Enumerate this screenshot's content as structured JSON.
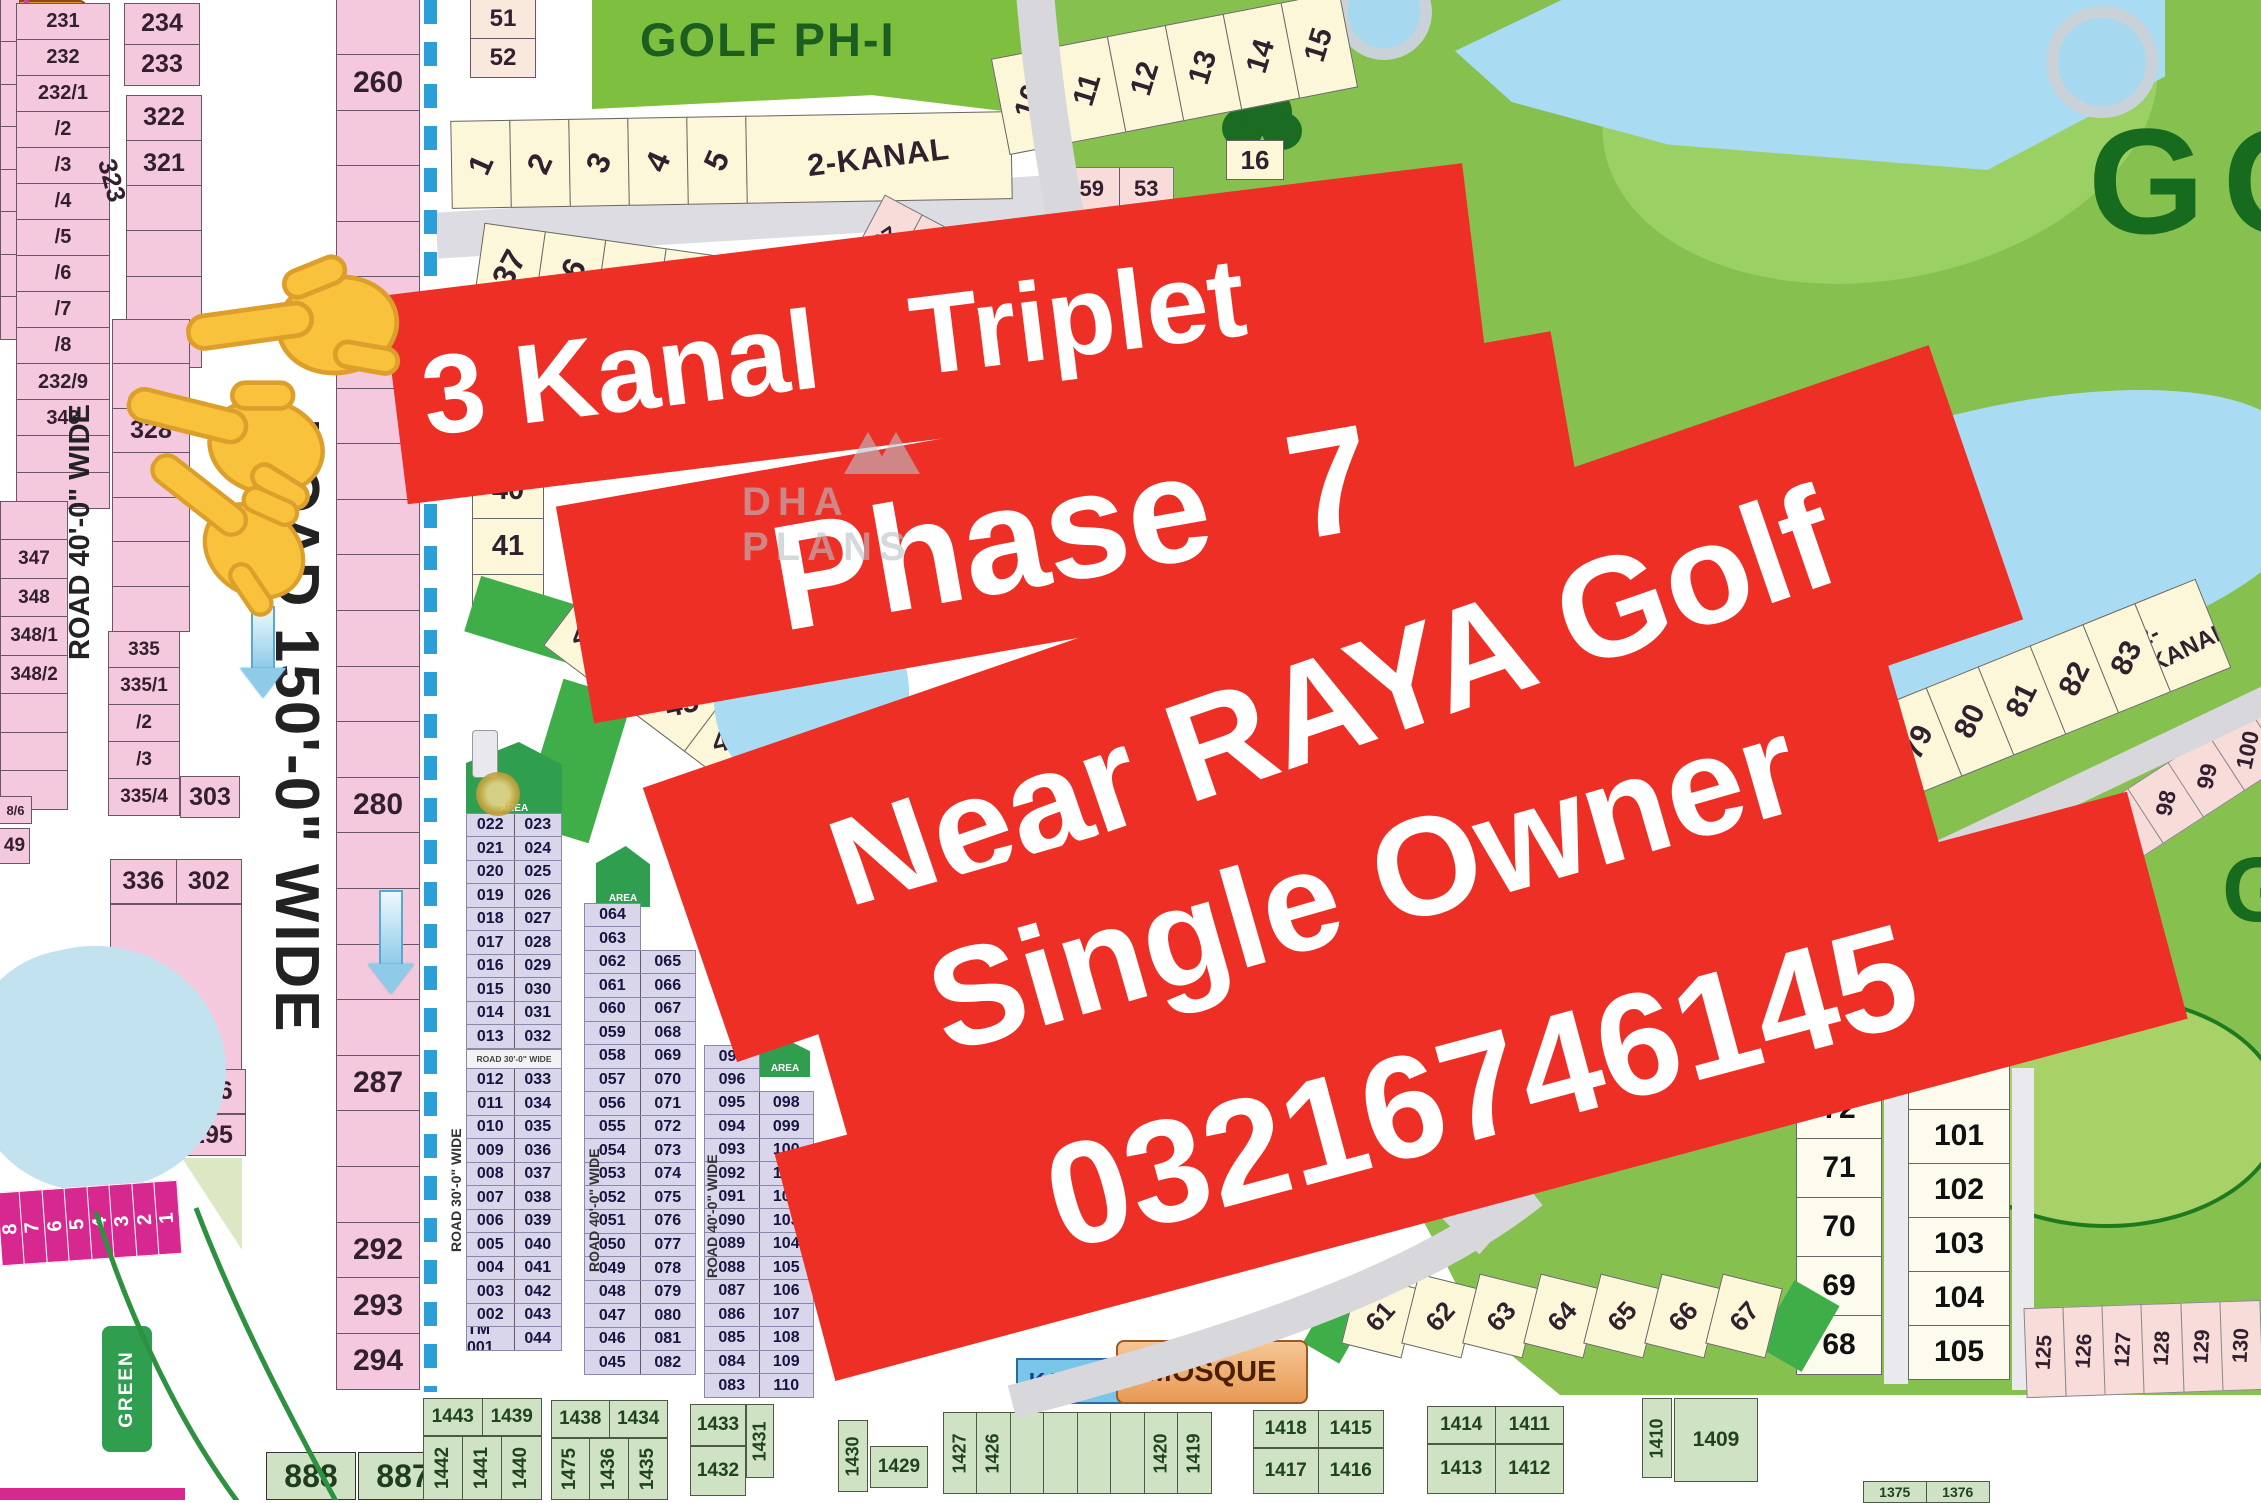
{
  "colors": {
    "banner_red": "#ee2f26",
    "pink": "#f5c9dd",
    "pink_light": "#f8dcda",
    "yellow": "#fbf7d8",
    "lavender": "#d9d5eb",
    "green_bright": "#3fae49",
    "green_cell": "#cfe3c4",
    "water": "#a9dcf2",
    "magenta": "#d6288e",
    "orange": "#e89440",
    "cyan": "#7ac6e8",
    "dashed_blue": "#2ba0d8"
  },
  "banner": {
    "lines": [
      "3 Kanal   Triplet",
      "Phase 7",
      "Near RAYA Golf",
      "Single Owner",
      "03216746145"
    ]
  },
  "watermark": {
    "text": "DHA PLANS"
  },
  "roads": {
    "r150": "ROAD 150'-0\" WIDE",
    "r40": "ROAD 40'-0\" WIDE",
    "r30": "ROAD 30'-0\" WIDE"
  },
  "golf": {
    "phase_label": "GOLF PH-I",
    "kanal_label": "2-KANAL",
    "big_word": "GOLF",
    "mosque": "MOSQUE",
    "kanal_small": "KANAL"
  },
  "left": {
    "edge0": [
      "",
      "",
      "",
      "",
      "",
      "",
      "",
      ""
    ],
    "col231": [
      "231",
      "232",
      "232/1",
      "/2",
      "/3",
      "/4",
      "/5",
      "/6",
      "/7",
      "/8",
      "232/9",
      "343",
      "",
      ""
    ],
    "pair234": [
      "234",
      "233"
    ],
    "col322": [
      "322",
      "321",
      "",
      "",
      "",
      ""
    ],
    "label323": "323",
    "col328": [
      "",
      "",
      "328",
      "",
      "",
      "",
      ""
    ],
    "col335": [
      "335",
      "335/1",
      "/2",
      "/3",
      "335/4"
    ],
    "edge347": [
      "",
      "347",
      "348",
      "348/1",
      "348/2",
      "",
      "",
      ""
    ],
    "lbl86": "8/6",
    "lbl49": "49",
    "p303": "303",
    "blk336": [
      [
        "336",
        "302"
      ]
    ],
    "blk342": [
      [
        "342",
        "296"
      ]
    ],
    "p295": "295",
    "strip260": [
      "",
      "260",
      "",
      "",
      "",
      "",
      "",
      "",
      "",
      "",
      "",
      "",
      "",
      "",
      "280",
      "",
      "",
      "",
      "",
      "287",
      "",
      "",
      "292",
      "293",
      "294"
    ],
    "magenta": [
      "8",
      "7",
      "6",
      "5",
      "4",
      "3",
      "2",
      "1"
    ],
    "dha": [
      "DHA",
      "SUPER",
      "MARKET",
      "2 KANAL"
    ],
    "green_box": "GREEN",
    "p888": "888",
    "p887": "887"
  },
  "top": {
    "p51p52": [
      "51",
      "52"
    ],
    "row1to5": [
      "1",
      "2",
      "3",
      "4",
      "5"
    ],
    "row10to15": [
      "10",
      "11",
      "12",
      "13",
      "14",
      "15"
    ],
    "p16": "16",
    "pinkpairs": [
      [
        "59",
        "53"
      ],
      [
        "60",
        "54"
      ]
    ],
    "pink6765": [
      "67",
      "66",
      "65"
    ],
    "row37": [
      "37",
      "36",
      "35",
      "34",
      "33",
      "32"
    ],
    "col38": [
      "38",
      "39",
      "40",
      "41",
      "42"
    ],
    "diag43": [
      "43",
      "44",
      "45",
      "46"
    ]
  },
  "grids": {
    "header": "AREA",
    "road_bar": "ROAD 30'-0\" WIDE",
    "a1": [
      [
        "022",
        "023"
      ],
      [
        "021",
        "024"
      ],
      [
        "020",
        "025"
      ],
      [
        "019",
        "026"
      ],
      [
        "018",
        "027"
      ],
      [
        "017",
        "028"
      ],
      [
        "016",
        "029"
      ],
      [
        "015",
        "030"
      ],
      [
        "014",
        "031"
      ],
      [
        "013",
        "032"
      ]
    ],
    "a2": [
      [
        "012",
        "033"
      ],
      [
        "011",
        "034"
      ],
      [
        "010",
        "035"
      ],
      [
        "009",
        "036"
      ],
      [
        "008",
        "037"
      ],
      [
        "007",
        "038"
      ],
      [
        "006",
        "039"
      ],
      [
        "005",
        "040"
      ],
      [
        "004",
        "041"
      ],
      [
        "003",
        "042"
      ],
      [
        "002",
        "043"
      ],
      [
        "TM 001",
        "044"
      ]
    ],
    "b_top": [
      "064",
      "063"
    ],
    "b": [
      [
        "062",
        "065"
      ],
      [
        "061",
        "066"
      ],
      [
        "060",
        "067"
      ],
      [
        "059",
        "068"
      ],
      [
        "058",
        "069"
      ],
      [
        "057",
        "070"
      ],
      [
        "056",
        "071"
      ],
      [
        "055",
        "072"
      ],
      [
        "054",
        "073"
      ],
      [
        "053",
        "074"
      ],
      [
        "052",
        "075"
      ],
      [
        "051",
        "076"
      ],
      [
        "050",
        "077"
      ],
      [
        "049",
        "078"
      ],
      [
        "048",
        "079"
      ],
      [
        "047",
        "080"
      ],
      [
        "046",
        "081"
      ],
      [
        "045",
        "082"
      ]
    ],
    "c_top": [
      "097",
      "096"
    ],
    "c": [
      [
        "095",
        "098"
      ],
      [
        "094",
        "099"
      ],
      [
        "093",
        "100"
      ],
      [
        "092",
        "101"
      ],
      [
        "091",
        "102"
      ],
      [
        "090",
        "103"
      ],
      [
        "089",
        "104"
      ],
      [
        "088",
        "105"
      ],
      [
        "087",
        "106"
      ],
      [
        "086",
        "107"
      ],
      [
        "085",
        "108"
      ],
      [
        "084",
        "109"
      ],
      [
        "083",
        "110"
      ]
    ]
  },
  "right": {
    "diag79": [
      "79",
      "80",
      "81",
      "82",
      "83"
    ],
    "diag96": [
      "96",
      "97",
      "98",
      "99",
      "100",
      "101"
    ],
    "col68": [
      "72",
      "71",
      "70",
      "69",
      "68"
    ],
    "col101": [
      "",
      "101",
      "102",
      "103",
      "104",
      "105"
    ],
    "pink125": [
      "125",
      "126",
      "127",
      "128",
      "129",
      "130"
    ],
    "diag61": [
      "61",
      "62",
      "63",
      "64",
      "65",
      "66",
      "67"
    ]
  },
  "bottom": {
    "g1_top": [
      "1443",
      "1439"
    ],
    "g1_bot": [
      "1442",
      "1441",
      "1440"
    ],
    "g2_top": [
      "1438",
      "1434"
    ],
    "g2_bot": [
      "1475",
      "1436",
      "1435"
    ],
    "g3": {
      "a": "1433",
      "b": "1431",
      "c": "1432",
      "d": "1430",
      "e": "1429"
    },
    "g4": [
      "1427",
      "1426",
      "",
      "",
      "",
      "",
      "1420",
      "1419"
    ],
    "g5_top": [
      "1418",
      "1415"
    ],
    "g5_bot": [
      "1417",
      "1416"
    ],
    "g6_top": [
      "1414",
      "1411"
    ],
    "g6_bot": [
      "1413",
      "1412"
    ],
    "g7_rot": "1410",
    "g7": "1409",
    "g8": [
      "1375",
      "1376"
    ]
  }
}
